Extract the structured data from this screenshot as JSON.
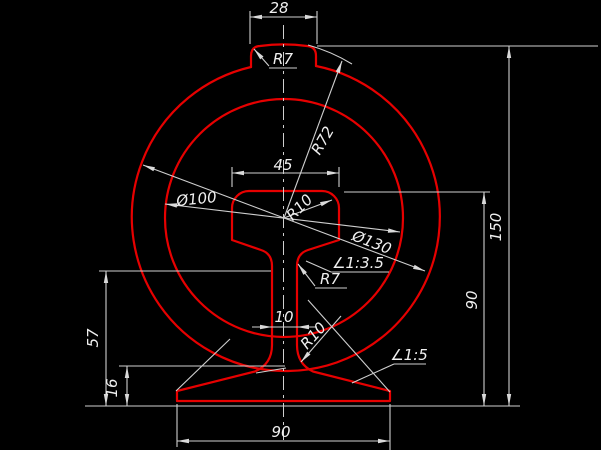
{
  "app": {
    "type": "cad-drawing-screenshot",
    "description": "AutoCAD-style engineering drawing: rail cross-section profile with two concentric circles and annotated dimensions on black background"
  },
  "colors": {
    "background": "#000000",
    "geometry_lines": "#e60000",
    "dimension_lines": "#cfcfcf",
    "dimension_text": "#f0f0f0"
  },
  "labels": {
    "top_width": "28",
    "fillet_top": "R7",
    "crown_radius": "R72",
    "head_width": "45",
    "inner_circle_diameter": "Ø100",
    "head_corner_radius": "R10",
    "outer_circle_diameter": "Ø130",
    "head_underside_slope": "∠1:3.5",
    "head_web_fillet": "R7",
    "web_thickness": "10",
    "web_foot_fillet": "R10",
    "foot_slope": "∠1:5",
    "height_to_head_jaw": "57",
    "foot_edge_thickness": "16",
    "foot_width": "90",
    "rail_height": "90",
    "total_height": "150"
  }
}
